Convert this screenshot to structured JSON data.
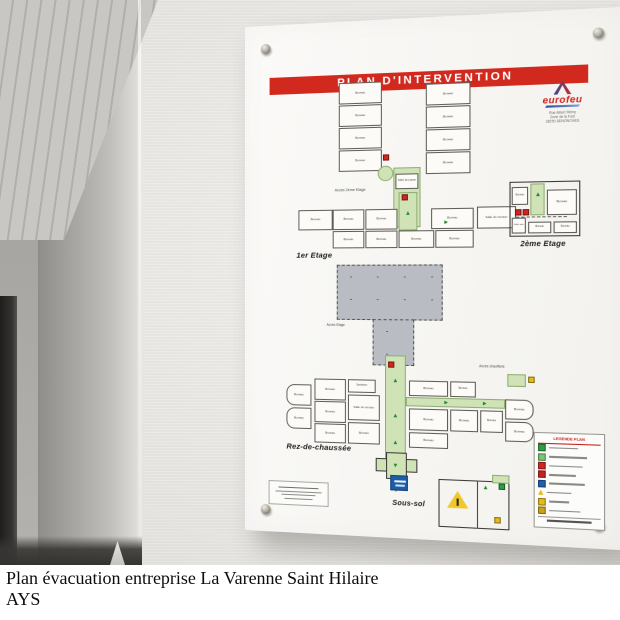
{
  "scene": {
    "caption": {
      "line1": "Plan évacuation entreprise La Varenne Saint Hilaire",
      "line2": "AYS"
    }
  },
  "plaque": {
    "banner": "PLAN D'INTERVENTION",
    "logo": {
      "brand": "eurofeu",
      "address": [
        "Rue Albert Rémy",
        "Zone de la Fust",
        "28250 SENONCHES"
      ]
    },
    "legend": {
      "title": "LEGENDE PLAN",
      "rows": [
        {
          "color": "#2e9e44"
        },
        {
          "color": "#7cc576"
        },
        {
          "color": "#d0261f"
        },
        {
          "color": "#c6211b"
        },
        {
          "color": "#1f5fb0"
        },
        {
          "color": "#e3bb1f",
          "shape": "triangle"
        },
        {
          "color": "#e3bb1f"
        },
        {
          "color": "#caa21d"
        }
      ]
    },
    "colors": {
      "banner_red": "#d2291f",
      "corridor_green": "#cfe3b6",
      "roof_gray": "#b9bdc3",
      "sign_blue": "#1d5da8",
      "marker_red": "#d0261f",
      "marker_yellow": "#e3bb1f",
      "marker_green": "#2e9e44"
    }
  },
  "floorplans": [
    {
      "id": "wing-upper",
      "x": 90,
      "y": 54,
      "w": 132,
      "h": 146,
      "elements": [
        {
          "t": "room",
          "x": 4,
          "y": 6,
          "w": 42,
          "h": 21,
          "label": "Bureau"
        },
        {
          "t": "room",
          "x": 4,
          "y": 28,
          "w": 42,
          "h": 21,
          "label": "Bureau"
        },
        {
          "t": "room",
          "x": 4,
          "y": 50,
          "w": 42,
          "h": 21,
          "label": "Bureau"
        },
        {
          "t": "room",
          "x": 4,
          "y": 72,
          "w": 42,
          "h": 21,
          "label": "Bureau"
        },
        {
          "t": "room",
          "x": 88,
          "y": 10,
          "w": 42,
          "h": 21,
          "label": "Bureau"
        },
        {
          "t": "room",
          "x": 88,
          "y": 32,
          "w": 42,
          "h": 21,
          "label": "Bureau"
        },
        {
          "t": "room",
          "x": 88,
          "y": 54,
          "w": 42,
          "h": 21,
          "label": "Bureau"
        },
        {
          "t": "room",
          "x": 88,
          "y": 76,
          "w": 42,
          "h": 21,
          "label": "Bureau"
        },
        {
          "t": "marker",
          "c": "red",
          "x": 47,
          "y": 77
        },
        {
          "t": "stair",
          "x": 42,
          "y": 88,
          "w": 15,
          "h": 15
        },
        {
          "t": "corr",
          "x": 57,
          "y": 90,
          "w": 26,
          "h": 58
        },
        {
          "t": "room",
          "x": 59,
          "y": 96,
          "w": 22,
          "h": 15,
          "label": "Salle de pause",
          "fs": 2.6
        },
        {
          "t": "arrow",
          "dir": "up",
          "x": 66,
          "y": 114
        },
        {
          "t": "marker",
          "c": "yellow",
          "x": 66,
          "y": 122
        },
        {
          "t": "marker",
          "c": "red",
          "x": 68,
          "y": 136
        },
        {
          "t": "label",
          "x": 0,
          "y": 110,
          "label": "Accès 2ème Etage",
          "fs": 3.6
        }
      ]
    },
    {
      "id": "first-floor",
      "x": 52,
      "y": 168,
      "w": 210,
      "h": 72,
      "elements": [
        {
          "t": "room",
          "x": 2,
          "y": 16,
          "w": 34,
          "h": 20,
          "label": "Bureau"
        },
        {
          "t": "room",
          "x": 36,
          "y": 16,
          "w": 31,
          "h": 20,
          "label": "Bureau"
        },
        {
          "t": "room",
          "x": 68,
          "y": 16,
          "w": 31,
          "h": 20,
          "label": "Bureau"
        },
        {
          "t": "room",
          "x": 131,
          "y": 16,
          "w": 40,
          "h": 20,
          "label": "Bureau"
        },
        {
          "t": "room",
          "x": 36,
          "y": 37,
          "w": 31,
          "h": 17,
          "label": "Bureau"
        },
        {
          "t": "room",
          "x": 68,
          "y": 37,
          "w": 31,
          "h": 17,
          "label": "Bureau"
        },
        {
          "t": "room",
          "x": 100,
          "y": 37,
          "w": 34,
          "h": 17,
          "label": "Bureau"
        },
        {
          "t": "room",
          "x": 135,
          "y": 37,
          "w": 36,
          "h": 17,
          "label": "Bureau"
        },
        {
          "t": "corr",
          "x": 100,
          "y": 0,
          "w": 18,
          "h": 37
        },
        {
          "t": "marker",
          "c": "red",
          "x": 103,
          "y": 2
        },
        {
          "t": "arrow",
          "dir": "up",
          "x": 105,
          "y": 18
        },
        {
          "t": "arrow",
          "dir": "right",
          "x": 140,
          "y": 26
        },
        {
          "t": "room",
          "x": 174,
          "y": 15,
          "w": 36,
          "h": 21,
          "label": "Salle de réunion",
          "fs": 2.8
        },
        {
          "t": "line",
          "x": 210,
          "y": 25,
          "w": 46,
          "h": 0,
          "dash": true
        },
        {
          "t": "label",
          "x": 0,
          "y": 57,
          "label": "1er Etage",
          "fs": 7.5,
          "b": true
        }
      ]
    },
    {
      "id": "second-floor",
      "x": 256,
      "y": 160,
      "w": 70,
      "h": 68,
      "elements": [
        {
          "t": "room",
          "x": 0,
          "y": 0,
          "w": 64,
          "h": 52,
          "thick": true
        },
        {
          "t": "corr",
          "x": 19,
          "y": 2,
          "w": 13,
          "h": 30
        },
        {
          "t": "arrow",
          "dir": "up",
          "x": 22,
          "y": 10
        },
        {
          "t": "room",
          "x": 34,
          "y": 8,
          "w": 27,
          "h": 24,
          "label": "Bureau",
          "fs": 3
        },
        {
          "t": "room",
          "x": 2,
          "y": 5,
          "w": 15,
          "h": 17,
          "label": "Bureau",
          "fs": 2.4
        },
        {
          "t": "marker",
          "c": "red",
          "x": 5,
          "y": 26
        },
        {
          "t": "marker",
          "c": "red",
          "x": 12,
          "y": 26
        },
        {
          "t": "room",
          "x": 2,
          "y": 34,
          "w": 13,
          "h": 15,
          "label": "Salle info",
          "fs": 2.2
        },
        {
          "t": "room",
          "x": 17,
          "y": 38,
          "w": 21,
          "h": 11,
          "label": "Bureau",
          "fs": 2.4
        },
        {
          "t": "room",
          "x": 40,
          "y": 38,
          "w": 21,
          "h": 11,
          "label": "Bureau",
          "fs": 2.4
        },
        {
          "t": "label",
          "x": 10,
          "y": 56,
          "label": "2ème Etage",
          "fs": 7,
          "b": true
        }
      ]
    },
    {
      "id": "roof-access",
      "x": 92,
      "y": 234,
      "w": 108,
      "h": 102,
      "elements": [
        {
          "t": "gray",
          "x": 0,
          "y": 4,
          "w": 102,
          "h": 54
        },
        {
          "t": "gray",
          "x": 35,
          "y": 57,
          "w": 40,
          "h": 45
        },
        {
          "t": "label",
          "x": -10,
          "y": 62,
          "label": "Accès Etage",
          "fs": 3.2
        }
      ]
    },
    {
      "id": "ground-floor",
      "x": 42,
      "y": 326,
      "w": 236,
      "h": 120,
      "elements": [
        {
          "t": "room",
          "x": 0,
          "y": 30,
          "w": 25,
          "h": 21,
          "label": "Bureau",
          "round": "l"
        },
        {
          "t": "room",
          "x": 0,
          "y": 53,
          "w": 25,
          "h": 21,
          "label": "Bureau",
          "round": "l"
        },
        {
          "t": "room",
          "x": 28,
          "y": 24,
          "w": 31,
          "h": 21,
          "label": "Bureau"
        },
        {
          "t": "room",
          "x": 28,
          "y": 46,
          "w": 31,
          "h": 21,
          "label": "Bureau"
        },
        {
          "t": "room",
          "x": 28,
          "y": 68,
          "w": 31,
          "h": 19,
          "label": "Bureau"
        },
        {
          "t": "room",
          "x": 61,
          "y": 24,
          "w": 27,
          "h": 13,
          "label": "Sanitaires",
          "fs": 2.4
        },
        {
          "t": "room",
          "x": 61,
          "y": 39,
          "w": 31,
          "h": 25,
          "label": "Salle de réunion",
          "fs": 2.8
        },
        {
          "t": "room",
          "x": 61,
          "y": 66,
          "w": 31,
          "h": 21,
          "label": "Bureau"
        },
        {
          "t": "corr",
          "x": 97,
          "y": 0,
          "w": 20,
          "h": 101
        },
        {
          "t": "marker",
          "c": "red",
          "x": 100,
          "y": 6
        },
        {
          "t": "arrow",
          "dir": "up",
          "x": 103,
          "y": 22
        },
        {
          "t": "arrow",
          "dir": "up",
          "x": 103,
          "y": 56
        },
        {
          "t": "arrow",
          "dir": "up",
          "x": 103,
          "y": 82
        },
        {
          "t": "corr",
          "x": 117,
          "y": 40,
          "w": 93,
          "h": 9
        },
        {
          "t": "arrow",
          "dir": "right",
          "x": 150,
          "y": 41
        },
        {
          "t": "arrow",
          "dir": "right",
          "x": 186,
          "y": 41
        },
        {
          "t": "room",
          "x": 120,
          "y": 24,
          "w": 37,
          "h": 15,
          "label": "Bureau"
        },
        {
          "t": "room",
          "x": 120,
          "y": 51,
          "w": 37,
          "h": 21,
          "label": "Bureau"
        },
        {
          "t": "room",
          "x": 120,
          "y": 74,
          "w": 37,
          "h": 15,
          "label": "Bureau"
        },
        {
          "t": "room",
          "x": 159,
          "y": 24,
          "w": 24,
          "h": 15,
          "label": "Bureau",
          "fs": 2.6
        },
        {
          "t": "room",
          "x": 159,
          "y": 51,
          "w": 26,
          "h": 21,
          "label": "Bureau"
        },
        {
          "t": "room",
          "x": 187,
          "y": 51,
          "w": 21,
          "h": 21,
          "label": "Bureau",
          "fs": 2.6
        },
        {
          "t": "room",
          "x": 210,
          "y": 40,
          "w": 26,
          "h": 19,
          "label": "Bureau",
          "round": "r"
        },
        {
          "t": "room",
          "x": 210,
          "y": 61,
          "w": 26,
          "h": 19,
          "label": "Bureau",
          "round": "r"
        },
        {
          "t": "label",
          "x": 186,
          "y": 8,
          "label": "Accès chaufferie",
          "fs": 3.2
        },
        {
          "t": "corr",
          "x": 212,
          "y": 16,
          "w": 17,
          "h": 12
        },
        {
          "t": "marker",
          "c": "yellow",
          "x": 231,
          "y": 18
        },
        {
          "t": "corr",
          "x": 88,
          "y": 100,
          "w": 40,
          "h": 13,
          "border": true
        },
        {
          "t": "corr",
          "x": 98,
          "y": 94,
          "w": 20,
          "h": 26,
          "border": true
        },
        {
          "t": "arrow",
          "dir": "down",
          "x": 103,
          "y": 102
        },
        {
          "t": "line",
          "x": 107,
          "y": 120,
          "w": 0,
          "h": 12,
          "v": true
        },
        {
          "t": "label",
          "x": 0,
          "y": 88,
          "label": "Rez-de-chaussée",
          "fs": 7.5,
          "b": true
        }
      ]
    },
    {
      "id": "basement",
      "x": 142,
      "y": 436,
      "w": 122,
      "h": 62,
      "elements": [
        {
          "t": "sign",
          "x": 2,
          "y": 6,
          "w": 17,
          "h": 15
        },
        {
          "t": "label",
          "x": 4,
          "y": 30,
          "label": "Sous-sol",
          "fs": 7,
          "b": true
        },
        {
          "t": "room",
          "x": 48,
          "y": 8,
          "w": 66,
          "h": 46,
          "thick": true
        },
        {
          "t": "line",
          "x": 84,
          "y": 8,
          "w": 0,
          "h": 46,
          "v": true,
          "dark": true
        },
        {
          "t": "tri",
          "x": 56,
          "y": 18,
          "w": 20,
          "h": 18
        },
        {
          "t": "marker",
          "c": "yellow",
          "x": 100,
          "y": 42
        },
        {
          "t": "corr",
          "x": 98,
          "y": 2,
          "w": 16,
          "h": 8
        },
        {
          "t": "marker",
          "c": "green",
          "x": 104,
          "y": 10
        },
        {
          "t": "arrow",
          "dir": "up",
          "x": 88,
          "y": 12
        }
      ]
    }
  ]
}
